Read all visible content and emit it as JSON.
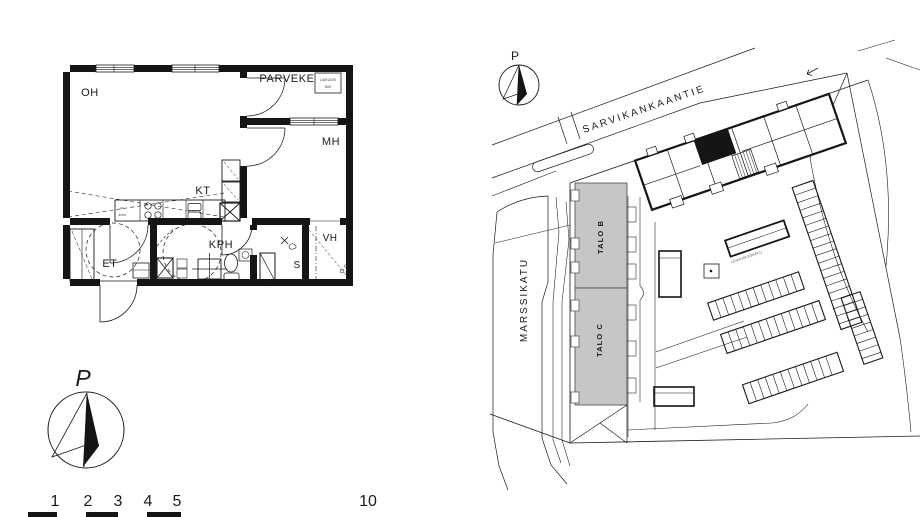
{
  "floor_plan": {
    "room_labels": {
      "living": "OH",
      "balcony": "PARVEKE",
      "bedroom": "MH",
      "kitchen": "KT",
      "bathroom": "KPH",
      "entry": "ET",
      "closet": "VH",
      "sauna": "S"
    },
    "balcony_tag": {
      "line1": "LIUKUOVI",
      "line2": "800"
    },
    "kitchen_tags": {
      "tag1": "AK",
      "tag2": "JK/PA"
    }
  },
  "compass": {
    "north_label": "P"
  },
  "site_plan": {
    "compass_north_label": "P",
    "street_top": "SARVIKANKAANTIE",
    "street_left": "MARSSIKATU",
    "building_b_label": "TALO B",
    "building_c_label": "TALO C",
    "courtyard_note": "LEIKKIOLESKELU"
  },
  "scale_bar": {
    "ticks": [
      "1",
      "2",
      "3",
      "4",
      "5"
    ],
    "end_label": "10"
  },
  "colors": {
    "ink": "#1a1a1a",
    "building_fill": "#c6c6c6",
    "background": "#ffffff"
  }
}
